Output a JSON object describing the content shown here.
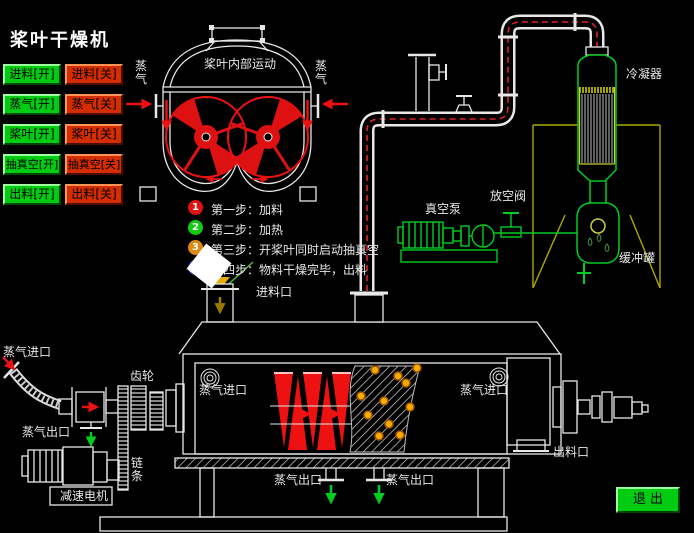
{
  "title": "桨叶干燥机",
  "buttons": {
    "rows": [
      {
        "on": "进料[开]",
        "off": "进料[关]"
      },
      {
        "on": "蒸气[开]",
        "off": "蒸气[关]"
      },
      {
        "on": "桨叶[开]",
        "off": "桨叶[关]"
      },
      {
        "on": "抽真空[开]",
        "off": "抽真空[关]"
      },
      {
        "on": "出料[开]",
        "off": "出料[关]"
      }
    ]
  },
  "vessel": {
    "caption": "桨叶内部运动",
    "steam_left": "蒸气",
    "steam_right": "蒸气"
  },
  "steps": [
    {
      "num": "1",
      "color": "#E11212",
      "text": "第一步：加料"
    },
    {
      "num": "2",
      "color": "#11CC11",
      "text": "第二步：加热"
    },
    {
      "num": "3",
      "color": "#DD8811",
      "text": "第三步：开桨叶同时启动抽真空"
    },
    {
      "num": "4",
      "color": "#2238C8",
      "text": "第四步：物料干燥完毕，出料"
    }
  ],
  "labels": {
    "feed_inlet": "进料口",
    "condenser": "冷凝器",
    "vacuum_pump": "真空泵",
    "vent_valve": "放空阀",
    "buffer_tank": "缓冲罐",
    "hose_steam_inlet": "蒸气进口",
    "joint_steam_outlet": "蒸气出口",
    "gear": "齿轮",
    "chain": "链条",
    "reducer_motor": "减速电机",
    "jacket_steam_inlet_left": "蒸气进口",
    "jacket_steam_inlet_right": "蒸气进口",
    "bottom_steam_outlet_left": "蒸气出口",
    "bottom_steam_outlet_right": "蒸气出口",
    "discharge_outlet": "出料口"
  },
  "exit_label": "退 出",
  "colors": {
    "button_on": "#00CC11",
    "button_off": "#D42D00",
    "machinery_green": "#00CC22",
    "frame_yellow": "#AAAA00",
    "paddle_red": "#EE1111",
    "material_dot": "#FFAA00"
  }
}
